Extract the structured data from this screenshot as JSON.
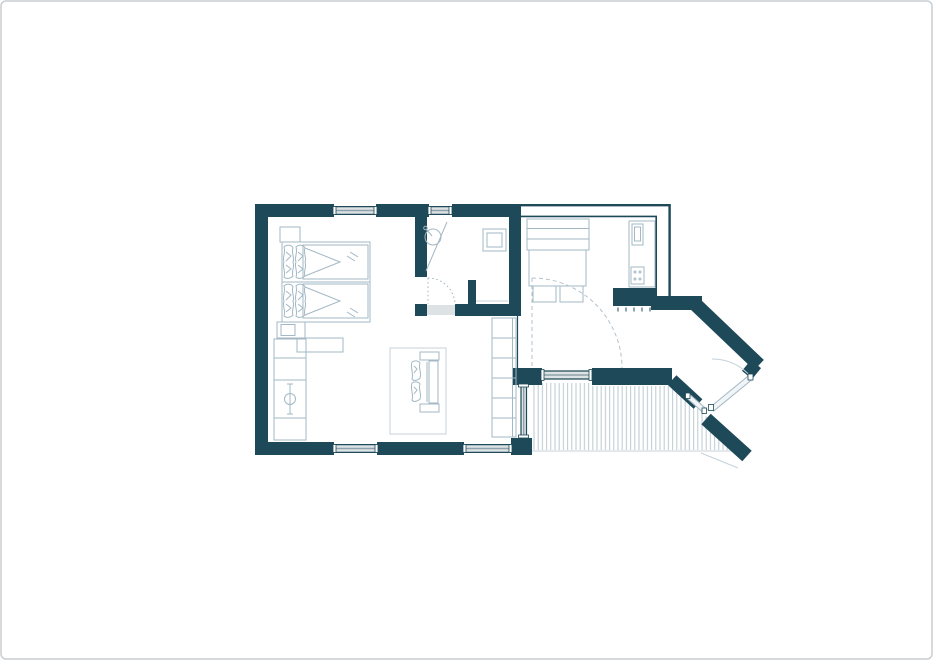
{
  "colors": {
    "background": "#ffffff",
    "frame": "#c9ced2",
    "wall": "#1d4958",
    "furniture": "#a3b8c4",
    "furniture_light": "#c4d2da",
    "window_fill": "#dde2e5",
    "window_mid": "#8fa1aa",
    "hatch": "#bac9d2",
    "dashed": "#b3c3cc",
    "glazing_fill": "#f2f5f7"
  },
  "floor_plan": {
    "type": "architectural-floor-plan",
    "elements": [
      "exterior-solid-walls",
      "exterior-hollow-walls",
      "interior-walls",
      "window",
      "double-bed",
      "pillows",
      "nightstand",
      "bench",
      "wardrobe",
      "rug",
      "sofa",
      "bookshelf",
      "bathroom-sink",
      "shower-screen",
      "toilet",
      "bathroom-door",
      "bed",
      "kitchen-counter",
      "kitchen-sink",
      "cooktop",
      "sliding-door-dashed",
      "deck-terrace",
      "entry-door",
      "sidelight",
      "door-swing-arc"
    ]
  }
}
